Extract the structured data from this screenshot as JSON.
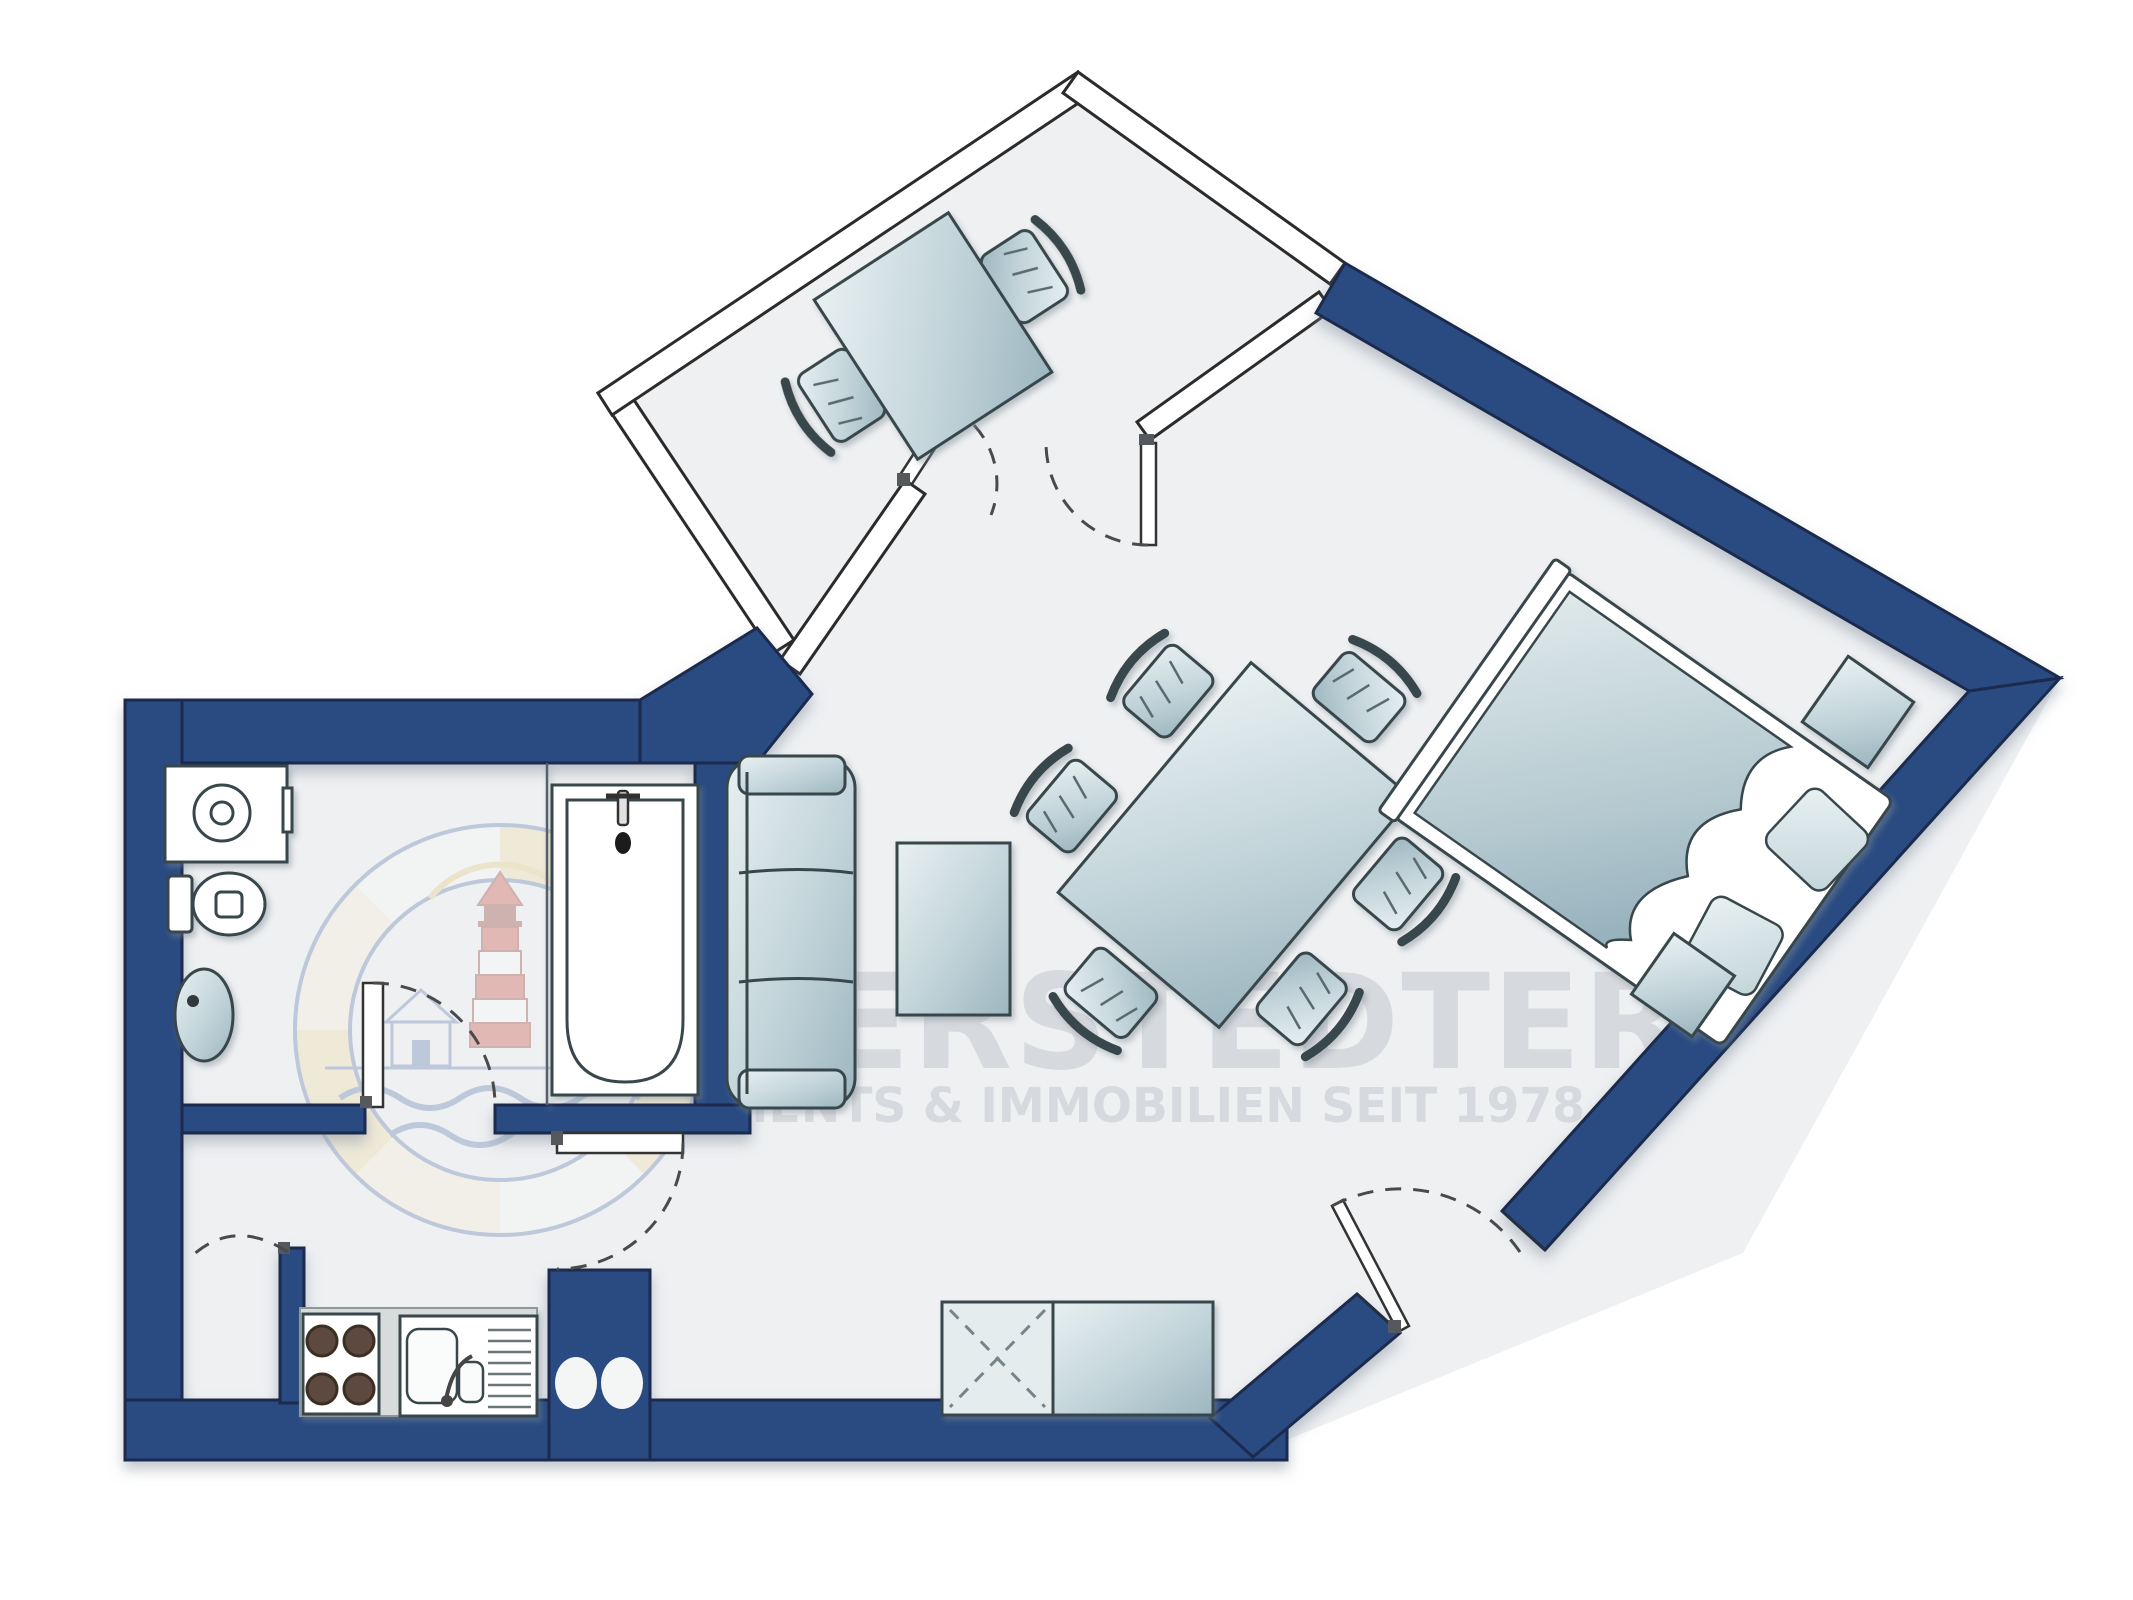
{
  "document": {
    "kind": "apartment-floor-plan",
    "orientation": "top-view"
  },
  "watermark": {
    "line1": "EIDERSTEDTER",
    "line2": "APPARTEMENTS & IMMOBILIEN SEIT 1978",
    "logo": "lighthouse-badge"
  },
  "colors": {
    "wall_blue": "#2a4c82",
    "wall_blue_dark": "#1a2b4d",
    "floor": "#eef0f2",
    "outside": "#ffffff",
    "thin_wall_stroke": "#2b2b2b",
    "furniture_stroke": "#39464b",
    "furniture_light": "#e8f0f1",
    "furniture_dark": "#a9c0c8",
    "counter_gray": "#d7dbdb",
    "burner": "#5d4a3f",
    "watermark_gray": "#d2d6da",
    "logo_yellow": "#f3dc9f",
    "logo_blue": "#5a77ad",
    "logo_red": "#cc4536",
    "dash": "#4a4a4a"
  },
  "elements": {
    "rooms_unlabeled": true,
    "balcony_furniture": [
      "balcony-table",
      "balcony-chair",
      "balcony-chair"
    ],
    "bathroom_fixtures": [
      "washing-machine",
      "toilet",
      "wash-basin",
      "bathtub"
    ],
    "kitchen_fixtures": [
      "countertop",
      "stove-4-burners",
      "kitchen-sink-with-drainboard",
      "hob-ovals"
    ],
    "living_furniture": [
      "sofa-3-seat",
      "coffee-table",
      "dining-table",
      "dining-chair x6",
      "wardrobe-x",
      "sideboard"
    ],
    "bedroom_furniture": [
      "double-bed",
      "pillow x2",
      "blanket",
      "nightstand",
      "stool"
    ],
    "doors": [
      "bathroom-door",
      "hall-door",
      "kitchen-door",
      "balcony-door-left",
      "balcony-door-right",
      "entrance-door"
    ]
  }
}
